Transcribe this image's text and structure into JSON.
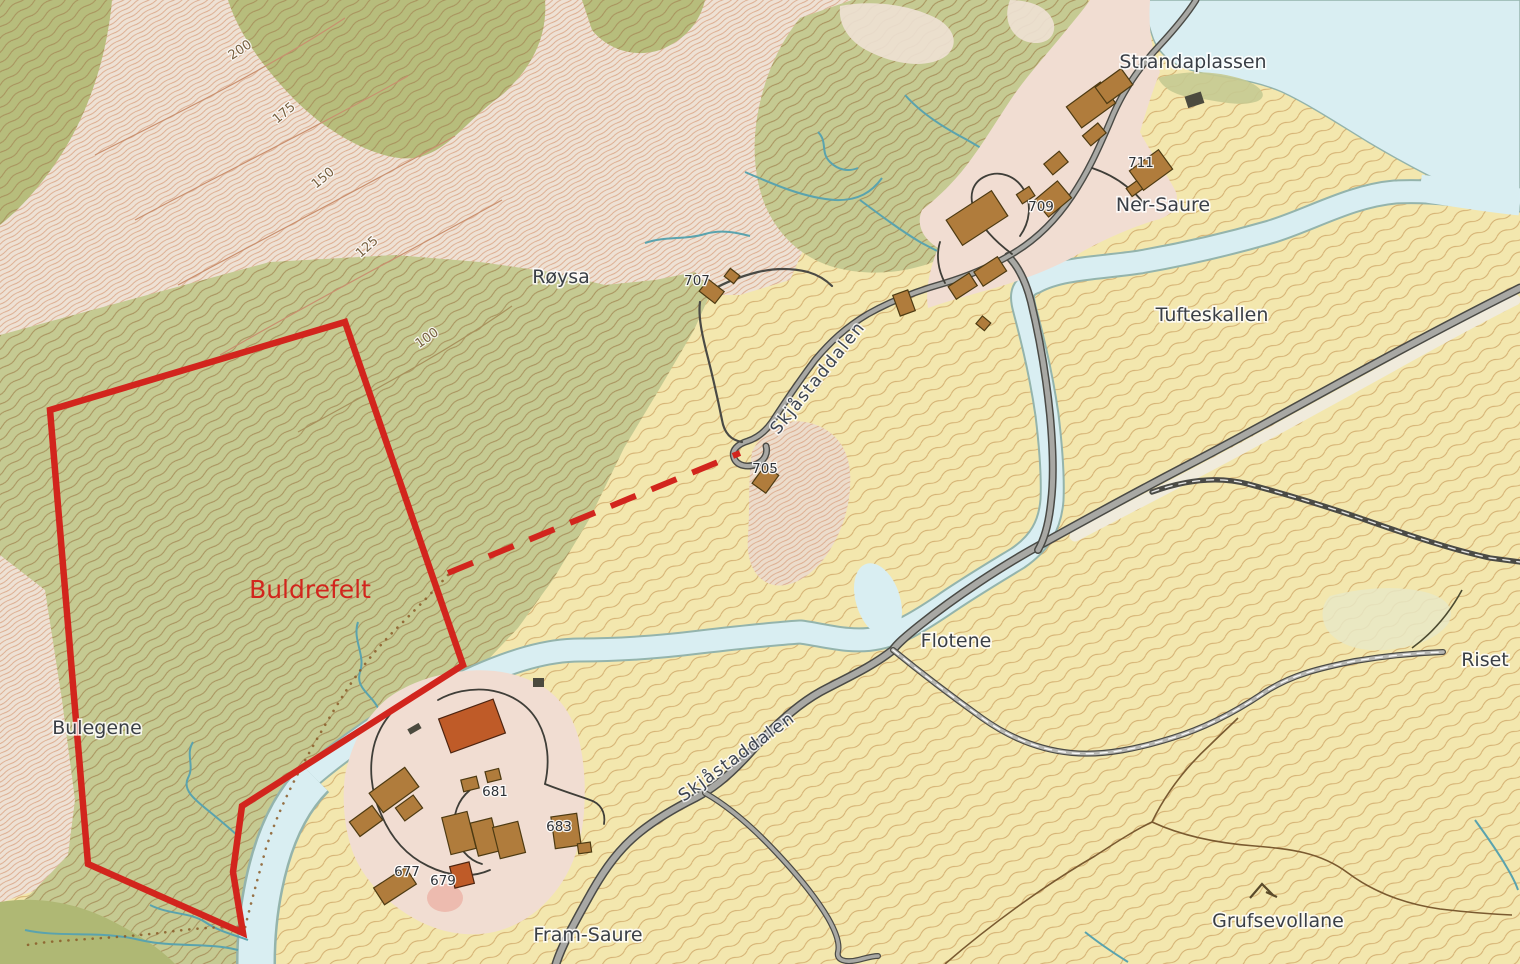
{
  "labels": {
    "strandaplassen": "Strandaplassen",
    "ner_saure": "Ner-Saure",
    "tufteskallen": "Tufteskallen",
    "roysa": "Røysa",
    "bulegene": "Bulegene",
    "flotene": "Flotene",
    "riset": "Riset",
    "fram_saure": "Fram-Saure",
    "grufsevollane": "Grufsevollane",
    "buldrefelt": "Buldrefelt",
    "road_upper": "Skjåstaddalen",
    "road_lower": "Skjåstaddalen"
  },
  "contour_labels": {
    "c200": "200",
    "c175": "175",
    "c150": "150",
    "c125": "125",
    "c100": "100"
  },
  "building_numbers": {
    "b705": "705",
    "b707": "707",
    "b709": "709",
    "b711": "711",
    "b677": "677",
    "b679": "679",
    "b681": "681",
    "b683": "683"
  },
  "colors": {
    "field_yellow": "#f3e7ae",
    "forest_green": "#c5ca92",
    "forest_green_dark": "#b7bd7c",
    "scree_pink": "#eee1d4",
    "settlement_pink": "#f1ddd2",
    "water": "#d9eef2",
    "water_edge": "#8fb3aa",
    "road_dark": "#4a4a45",
    "road_fill": "#a8a8a4",
    "building_brown": "#b07c3c",
    "building_red": "#bf5b28",
    "boundary_red": "#d2251d",
    "label_dark": "#3a3f46"
  }
}
